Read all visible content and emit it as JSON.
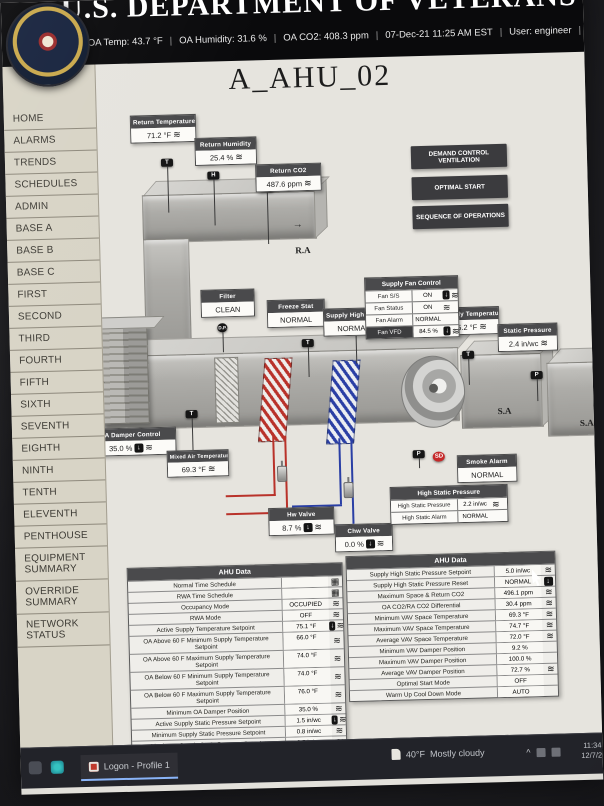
{
  "icons": {
    "zigzag": "≋",
    "override_arrow": "↓",
    "calendar": "▦",
    "arrow_right": "→",
    "tray_expand": "^"
  },
  "colors": {
    "alarm_red": "#c62828",
    "hot_water": "#b9322a",
    "chilled_water": "#2a3fa5"
  },
  "header": {
    "org_title": "U.S. DEPARTMENT OF VETERANS AFFAIRS",
    "status_segments": [
      "OA Temp:  43.7 °F",
      "OA Humidity:  31.6 %",
      "OA CO2:  408.3 ppm",
      "07-Dec-21 11:25 AM EST",
      "User: engineer",
      "Alarm Status:"
    ]
  },
  "sidebar": {
    "items": [
      "HOME",
      "ALARMS",
      "TRENDS",
      "SCHEDULES",
      "ADMIN",
      "BASE A",
      "BASE B",
      "BASE C",
      "FIRST",
      "SECOND",
      "THIRD",
      "FOURTH",
      "FIFTH",
      "SIXTH",
      "SEVENTH",
      "EIGHTH",
      "NINTH",
      "TENTH",
      "ELEVENTH",
      "PENTHOUSE",
      "EQUIPMENT SUMMARY",
      "OVERRIDE SUMMARY",
      "NETWORK STATUS"
    ]
  },
  "main": {
    "title": "A_AHU_02",
    "buttons": [
      {
        "label": "DEMAND CONTROL VENTILATION"
      },
      {
        "label": "OPTIMAL START"
      },
      {
        "label": "SEQUENCE OF OPERATIONS"
      }
    ],
    "diagram": {
      "return_temperature": {
        "label": "Return Temperature",
        "value": "71.2 °F"
      },
      "return_humidity": {
        "label": "Return Humidity",
        "value": "25.4 %"
      },
      "return_co2": {
        "label": "Return CO2",
        "value": "487.6 ppm"
      },
      "filter": {
        "label": "Filter",
        "value": "CLEAN"
      },
      "freeze_stat": {
        "label": "Freeze Stat",
        "value": "NORMAL"
      },
      "supply_high_limit": {
        "label": "Supply High Limit",
        "value": "NORMAL"
      },
      "supply_temperature": {
        "label": "Supply Temperature",
        "value": "75.2 °F"
      },
      "static_pressure": {
        "label": "Static Pressure",
        "value": "2.4 in/wc"
      },
      "oa_damper_control": {
        "label": "OA Damper Control",
        "value": "35.0 %"
      },
      "mixed_air_temperature": {
        "label": "Mixed Air Temperature",
        "value": "69.3 °F"
      },
      "hw_valve": {
        "label": "Hw Valve",
        "value": "8.7 %"
      },
      "chw_valve": {
        "label": "Chw Valve",
        "value": "0.0 %"
      },
      "smoke_alarm": {
        "label": "Smoke Alarm",
        "value": "NORMAL"
      },
      "supply_fan_control": {
        "title": "Supply Fan Control",
        "rows": [
          {
            "label": "Fan S/S",
            "value": "ON",
            "icons": [
              "hand",
              "zz"
            ]
          },
          {
            "label": "Fan Status",
            "value": "ON",
            "icons": [
              "zz"
            ]
          },
          {
            "label": "Fan Alarm",
            "value": "NORMAL",
            "icons": []
          },
          {
            "label": "Fan VFD",
            "value": "84.5 %",
            "icons": [
              "hand",
              "zz"
            ],
            "dark_label": true
          }
        ]
      },
      "high_static": {
        "title": "High Static Pressure",
        "rows": [
          {
            "label": "High Static Pressure",
            "value": "2.2 in/wc",
            "icons": [
              "zz"
            ]
          },
          {
            "label": "High Static Alarm",
            "value": "NORMAL",
            "icons": []
          }
        ]
      },
      "labels": {
        "oa": "O.A",
        "ra": "R.A",
        "sa": "S.A"
      },
      "sensor_tags": {
        "temperature": "T",
        "humidity": "H",
        "co2": "CO2",
        "pressure": "P",
        "smoke_detector": "SD",
        "diff_pressure": "D.P."
      }
    },
    "tables": {
      "left": {
        "title": "AHU Data",
        "rows": [
          {
            "label": "Normal Time Schedule",
            "value": "",
            "icons": [
              "cal"
            ]
          },
          {
            "label": "RWA Time Schedule",
            "value": "",
            "icons": [
              "cal"
            ]
          },
          {
            "label": "Occupancy Mode",
            "value": "OCCUPIED",
            "icons": [
              "zz"
            ]
          },
          {
            "label": "RWA Mode",
            "value": "OFF",
            "icons": [
              "zz"
            ]
          },
          {
            "label": "Active Supply Temperature Setpoint",
            "value": "75.1 °F",
            "icons": [
              "hand",
              "zz"
            ]
          },
          {
            "label": "OA Above 60 F Minimum Supply Temperature Setpoint",
            "value": "66.0 °F",
            "icons": [
              "zz"
            ]
          },
          {
            "label": "OA Above 60 F Maximum Supply Temperature Setpoint",
            "value": "74.0 °F",
            "icons": [
              "zz"
            ]
          },
          {
            "label": "OA Below 60 F Minimum Supply Temperature Setpoint",
            "value": "74.0 °F",
            "icons": [
              "zz"
            ]
          },
          {
            "label": "OA Below 60 F Maximum Supply Temperature Setpoint",
            "value": "76.0 °F",
            "icons": [
              "zz"
            ]
          },
          {
            "label": "Minimum OA Damper Position",
            "value": "35.0 %",
            "icons": [
              "zz"
            ]
          },
          {
            "label": "Active Supply Static Pressure Setpoint",
            "value": "1.5 in/wc",
            "icons": [
              "hand",
              "zz"
            ]
          },
          {
            "label": "Minimum Supply Static Pressure Setpoint",
            "value": "0.8 in/wc",
            "icons": [
              "zz"
            ]
          },
          {
            "label": "Maximum Supply Static Pressure Setpoint",
            "value": "2.5 in/wc",
            "icons": [
              "zz"
            ]
          }
        ]
      },
      "right": {
        "title": "AHU Data",
        "rows": [
          {
            "label": "Supply High Static Pressure Setpoint",
            "value": "5.0 in/wc",
            "icons": [
              "zz"
            ]
          },
          {
            "label": "Supply High Static Pressure Reset",
            "value": "NORMAL",
            "icons": [
              "hand"
            ]
          },
          {
            "label": "Maximum Space & Return CO2",
            "value": "496.1 ppm",
            "icons": [
              "zz"
            ]
          },
          {
            "label": "OA CO2/RA CO2 Differential",
            "value": "30.4 ppm",
            "icons": [
              "zz"
            ]
          },
          {
            "label": "Minimum VAV Space Temperature",
            "value": "69.3 °F",
            "icons": [
              "zz"
            ]
          },
          {
            "label": "Maximum VAV Space Temperature",
            "value": "74.7 °F",
            "icons": [
              "zz"
            ]
          },
          {
            "label": "Average VAV Space Temperature",
            "value": "72.0 °F",
            "icons": [
              "zz"
            ]
          },
          {
            "label": "Minimum VAV Damper Position",
            "value": "9.2 %",
            "icons": []
          },
          {
            "label": "Maximum VAV Damper Position",
            "value": "100.0 %",
            "icons": []
          },
          {
            "label": "Average VAV Damper Position",
            "value": "72.7 %",
            "icons": [
              "zz"
            ]
          },
          {
            "label": "Optimal Start Mode",
            "value": "OFF",
            "icons": []
          },
          {
            "label": "Warm Up Cool Down Mode",
            "value": "AUTO",
            "icons": []
          }
        ]
      }
    }
  },
  "taskbar": {
    "window_label": "Logon - Profile 1",
    "weather": {
      "temp": "40°F",
      "desc": "Mostly cloudy"
    },
    "clock": {
      "time": "11:34 AM",
      "date": "12/7/2021"
    }
  }
}
